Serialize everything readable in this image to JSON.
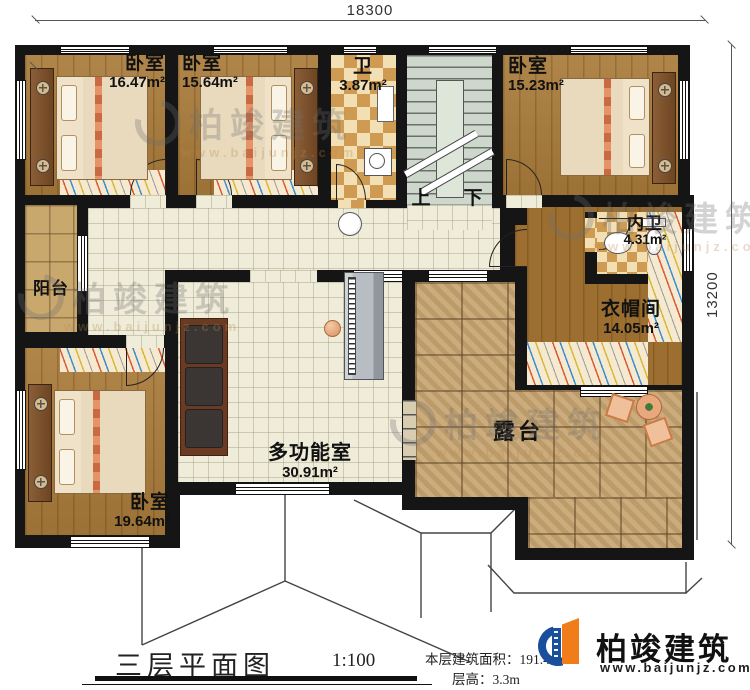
{
  "dimensions": {
    "top": "18300",
    "right": "13200"
  },
  "rooms": {
    "bedroom1": {
      "label": "卧室",
      "area": "16.47m²"
    },
    "bedroom2": {
      "label": "卧室",
      "area": "15.64m²"
    },
    "bath": {
      "label": "卫",
      "area": "3.87m²"
    },
    "bedroom3": {
      "label": "卧室",
      "area": "15.23m²"
    },
    "inner_bath": {
      "label": "内卫",
      "area": "4.31m²"
    },
    "cloakroom": {
      "label": "衣帽间",
      "area": "14.05m²"
    },
    "balcony": {
      "label": "阳台"
    },
    "bedroom4": {
      "label": "卧室",
      "area": "19.64m²"
    },
    "multi_room": {
      "label": "多功能室",
      "area": "30.91m²"
    },
    "terrace": {
      "label": "露台"
    }
  },
  "stairs": {
    "up": "上",
    "down": "下"
  },
  "title_block": {
    "title": "三层平面图",
    "scale": "1:100",
    "area_label": "本层建筑面积：",
    "area_value": "191.41m²",
    "floor_height_label": "层高：",
    "floor_height_value": "3.3m"
  },
  "logo": {
    "name": "柏竣建筑",
    "website": "www.baijunjz.com"
  },
  "watermark": {
    "text": "柏竣建筑",
    "website": "www.baijunjz.com"
  },
  "colors": {
    "wall": "#151515",
    "wood": "#a97b3a",
    "tile": "#efecd9",
    "paver": "#c8a571",
    "checker": "#cf9b52",
    "stairs": "#cdd7cc",
    "logo_blue": "#1a4f9c",
    "logo_orange": "#f07c1a"
  }
}
